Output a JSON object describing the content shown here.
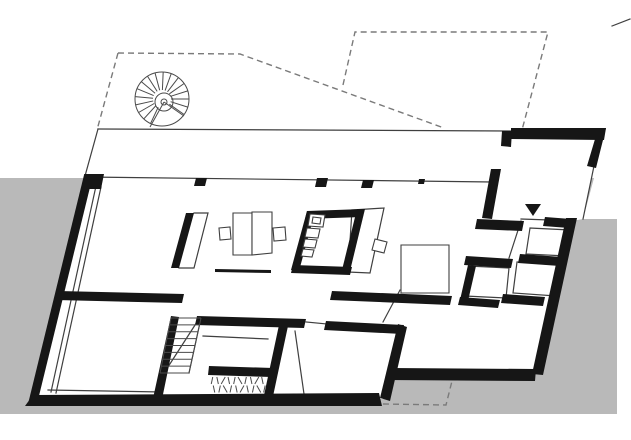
{
  "colors": {
    "bg": "#ffffff",
    "ground": "#b9b9b9",
    "wall": "#161616",
    "line": "#3f3f3f",
    "dash": "#7a7a7a",
    "stairline": "#4a4a4a"
  },
  "canvas": {
    "width": 631,
    "height": 440
  },
  "plan": {
    "ground_points": "0,178 594,178 583,219 617,219 617,414 0,414",
    "building_points": "98,129 606,131 594,166 583,219 572,221 537,373 395,371 385,399 28,405 85,175",
    "walls": [
      "84,175 93,175 37,404 28,404",
      "84,174 104,174 101,189 87,189",
      "33,395 379,393 382,406 25,406",
      "398,324 407,327 390,401 380,398",
      "391,368 536,369 535,381 386,380",
      "566,218 577,218 543,375 532,374",
      "511,128 606,128 604,140 511,139",
      "598,129 606,128 596,168 587,166",
      "502,131 512,131 511,147 501,146",
      "491,169 501,169 492,219 482,218",
      "477,219 524,221 522,231 475,229",
      "58,291 184,294 182,303 56,300",
      "332,291 452,296 450,305 330,300",
      "197,316 306,319 304,328 195,325",
      "279,325 288,326 272,401 263,400",
      "326,321 404,325 402,334 324,330",
      "171,316 179,317 161,404 152,403",
      "209,366 273,368 272,377 208,375",
      "186,213 194,213 179,268 171,268",
      "307,211 315,212 299,271 291,270",
      "307,211 364,209 362,217 305,219",
      "357,209 365,209 350,271 342,270",
      "293,265 352,267 350,275 291,273",
      "466,256 513,259 511,268 464,265",
      "468,265 476,266 468,301 460,300",
      "460,297 500,300 498,308 458,305",
      "520,254 562,257 560,266 518,263",
      "545,217 571,219 569,228 543,226",
      "503,294 545,297 543,306 501,303",
      "196,178 207,178 205,186 194,186",
      "317,178 328,178 326,187 315,187",
      "363,180 374,180 372,188 361,188",
      "419,179 425,179 424,184 418,184"
    ],
    "thin_lines": [
      "98,129 512,131",
      "98,129 85,176",
      "86,177 492,182",
      "594,166 583,219",
      "96,186 51,392",
      "101,187 56,393",
      "48,390 162,392",
      "203,336 268,339",
      "400,290 383,322",
      "295,331 304,394",
      "521,221 509,258",
      "521,219 549,220",
      "194,213 208,213 194,268 179,268",
      "352,210 384,208 370,273 348,272 352,210",
      "530,228 570,230 567,256 526,254 530,228",
      "517,262 559,265 556,296 513,293 517,262",
      "469,266 509,268 506,298 465,296 469,266",
      "201,318 189,373",
      "166,370 197,322",
      "612,26 630,19",
      "306,322 327,324",
      "403,330 396,367"
    ],
    "dashed_outlines": [
      "118,53 240,54 444,128",
      "118,53 97,130",
      "343,85 355,32 548,32 522,130",
      "383,404 446,405 454,373"
    ],
    "furniture": [
      {
        "points": "233,213 252,213 252,255 233,255",
        "cls": "furn"
      },
      {
        "points": "252,212 272,212 272,253 252,255",
        "cls": "furn"
      },
      {
        "points": "219,228 230,227 231,239 220,240",
        "cls": "furn"
      },
      {
        "points": "273,228 285,227 286,240 274,241",
        "cls": "furn"
      },
      {
        "points": "401,245 449,245 449,293 401,293",
        "cls": "furn"
      },
      {
        "points": "375,239 387,242 384,253 372,250",
        "cls": "furn"
      },
      {
        "points": "310,214 325,215 323,227 308,226",
        "cls": "furn"
      },
      {
        "points": "313,217 321,218 320,224 312,223",
        "cls": "furn"
      },
      {
        "points": "307,228 320,229 318,238 305,237",
        "cls": "furn"
      },
      {
        "points": "305,239 317,240 315,248 303,247",
        "cls": "furn"
      },
      {
        "points": "303,249 314,250 312,257 301,256",
        "cls": "furn"
      },
      {
        "points": "215,269 271,270 271,273 215,272",
        "cls": "marker"
      }
    ],
    "entrance_marker_points": "525,204 541,204 533,216",
    "spiral_stair": {
      "cx": 162,
      "cy": 99,
      "outer_r": 27,
      "inner_r": 9,
      "hub_r": 3,
      "spokes": 17,
      "start_deg": 115,
      "end_deg": 395,
      "wedge": [
        "150,127",
        "184,116"
      ]
    },
    "straight_stair": {
      "top_left": [
        171,
        318
      ],
      "top_right": [
        201,
        318
      ],
      "bottom_left": [
        160,
        373
      ],
      "bottom_right": [
        189,
        373
      ],
      "treads": 9
    },
    "hatch": {
      "x": 212,
      "y": 377,
      "rows": 2,
      "row_h": 8.5,
      "count": 10,
      "step": 5.6
    }
  }
}
